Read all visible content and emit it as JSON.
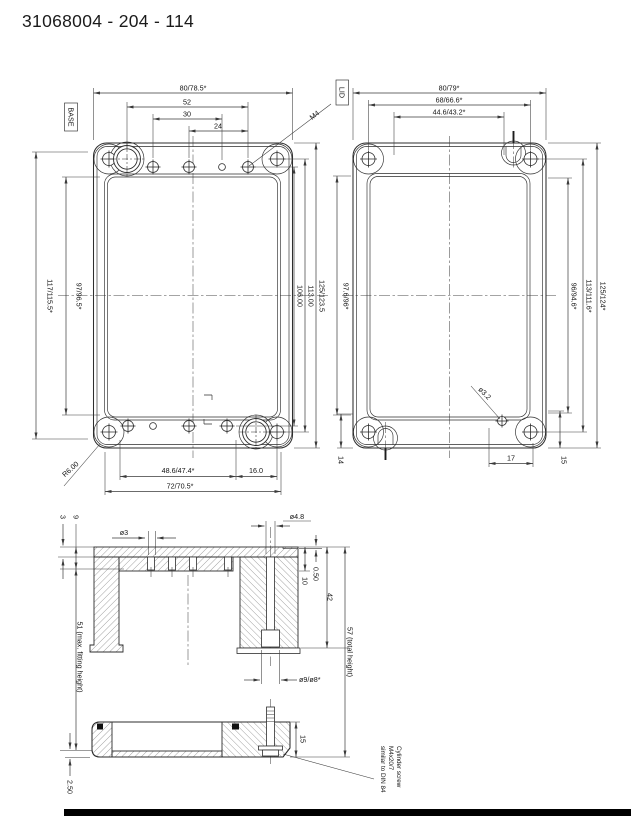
{
  "title": "31068004 - 204 - 114",
  "base": {
    "label": "BASE",
    "dim_width_outer": "80/78.5*",
    "dim_52": "52",
    "dim_30": "30",
    "dim_24": "24",
    "dim_height_outer": "117/115.5*",
    "dim_height_inner": "97/96.5*",
    "dim_106": "106.00",
    "dim_113": "113.00",
    "dim_125": "125/123.5",
    "dim_486": "48.6/47.4*",
    "dim_16": "16.0",
    "dim_72": "72/70.5*",
    "m4": "M4",
    "r6": "R6.00"
  },
  "lid": {
    "label": "LID",
    "dim_width_outer": "80/79*",
    "dim_68": "68/66.6*",
    "dim_446": "44.6/43.2*",
    "dim_976": "97.6/96*",
    "dim_96": "96/94.6*",
    "dim_113": "113/111.6*",
    "dim_125": "125/124*",
    "hole_dia": "ø3.2",
    "dim_17": "17",
    "dim_14": "14",
    "dim_15": "15"
  },
  "section": {
    "d3": "3",
    "d9": "9",
    "dia3": "ø3",
    "dia48": "ø4.8",
    "d050": "0.50",
    "d10": "10",
    "d42": "42",
    "fitting": "51 (max. fitting height)",
    "total": "57 (total height)",
    "dia98": "ø9/ø8*",
    "d15": "15",
    "d250": "2.50",
    "note1": "Cylinder screw",
    "note2": "M4x20/7",
    "note3": "similar to DIN 84"
  }
}
